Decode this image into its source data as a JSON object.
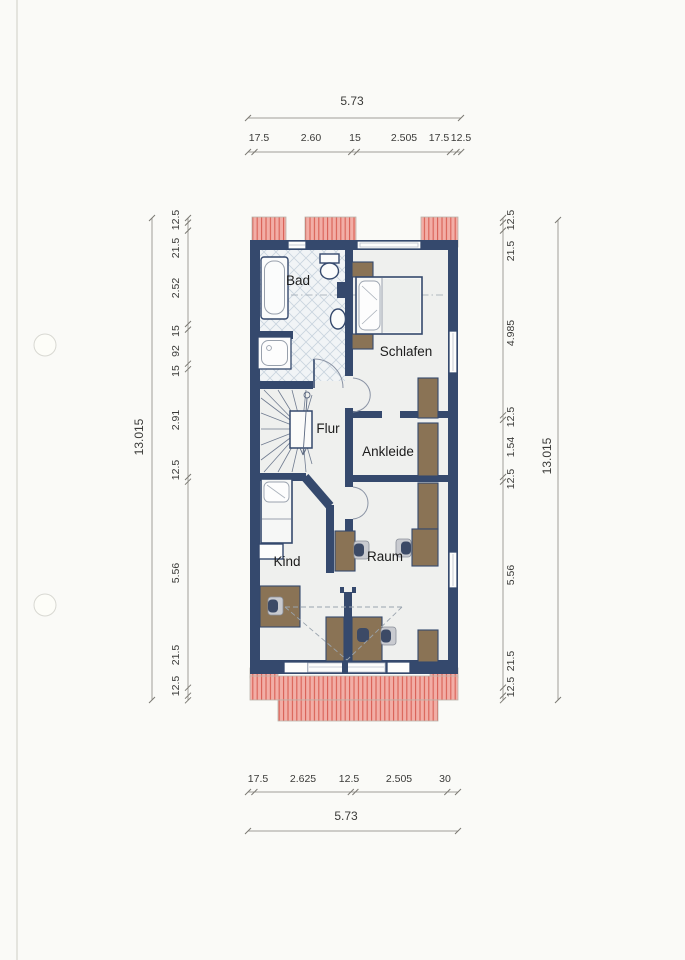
{
  "rooms": {
    "bad": "Bad",
    "schlafen": "Schlafen",
    "flur": "Flur",
    "ankleide": "Ankleide",
    "kind": "Kind",
    "raum": "Raum"
  },
  "dims": {
    "top_total": "5.73",
    "top_chain": [
      "17.5",
      "2.60",
      "15",
      "2.505",
      "17.5",
      "12.5"
    ],
    "left_outer": "13.015",
    "left_chain": [
      "12.5",
      "21.5",
      "2.52",
      "15",
      "92",
      "15",
      "2.91",
      "12.5",
      "5.56",
      "21.5",
      "12.5"
    ],
    "right_chain": [
      "12.5",
      "21.5",
      "4.985",
      "12.5",
      "1.54",
      "12.5",
      "5.56",
      "21.5",
      "12.5"
    ],
    "right_outer": "13.015",
    "bottom_chain": [
      "17.5",
      "2.625",
      "12.5",
      "2.505",
      "30"
    ],
    "bottom_total": "5.73"
  },
  "colors": {
    "paper": "#fafaf7",
    "wall": "#35496d",
    "floor": "#eff0ee",
    "roof_fill": "#f2aea6",
    "roof_line": "#d96055",
    "furniture": "#8a7355",
    "chair_dark": "#3c4a66",
    "tile_bg": "#f1f4f6",
    "tile_line": "#c9d4de",
    "door_arc": "#8b94a5",
    "dash_line": "#9aa4ae",
    "dim_line": "#a09e98",
    "dim_text": "#3a3a38",
    "label_text": "#1c1c1c"
  }
}
